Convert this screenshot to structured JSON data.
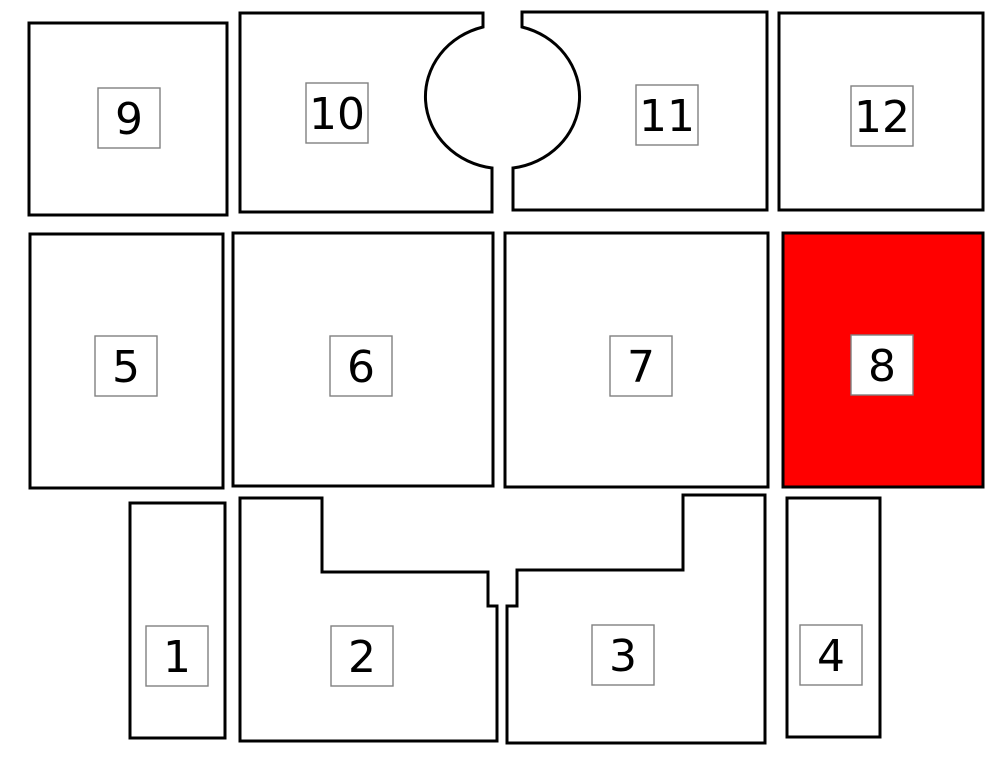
{
  "figure": {
    "type": "floor-plan-diagram",
    "background_color": "#ffffff",
    "outline_color": "#000000",
    "default_unit_fill": "#ffffff",
    "highlight_color": "#ff0000",
    "label_box_fill": "#ffffff",
    "label_box_border_color": "#808080",
    "label_text_color": "#000000",
    "highlighted_unit": "8"
  },
  "units": [
    {
      "id": "1",
      "label": "1",
      "highlighted": false,
      "fill": "#ffffff"
    },
    {
      "id": "2",
      "label": "2",
      "highlighted": false,
      "fill": "#ffffff"
    },
    {
      "id": "3",
      "label": "3",
      "highlighted": false,
      "fill": "#ffffff"
    },
    {
      "id": "4",
      "label": "4",
      "highlighted": false,
      "fill": "#ffffff"
    },
    {
      "id": "5",
      "label": "5",
      "highlighted": false,
      "fill": "#ffffff"
    },
    {
      "id": "6",
      "label": "6",
      "highlighted": false,
      "fill": "#ffffff"
    },
    {
      "id": "7",
      "label": "7",
      "highlighted": false,
      "fill": "#ffffff"
    },
    {
      "id": "8",
      "label": "8",
      "highlighted": true,
      "fill": "#ff0000"
    },
    {
      "id": "9",
      "label": "9",
      "highlighted": false,
      "fill": "#ffffff"
    },
    {
      "id": "10",
      "label": "10",
      "highlighted": false,
      "fill": "#ffffff"
    },
    {
      "id": "11",
      "label": "11",
      "highlighted": false,
      "fill": "#ffffff"
    },
    {
      "id": "12",
      "label": "12",
      "highlighted": false,
      "fill": "#ffffff"
    }
  ]
}
